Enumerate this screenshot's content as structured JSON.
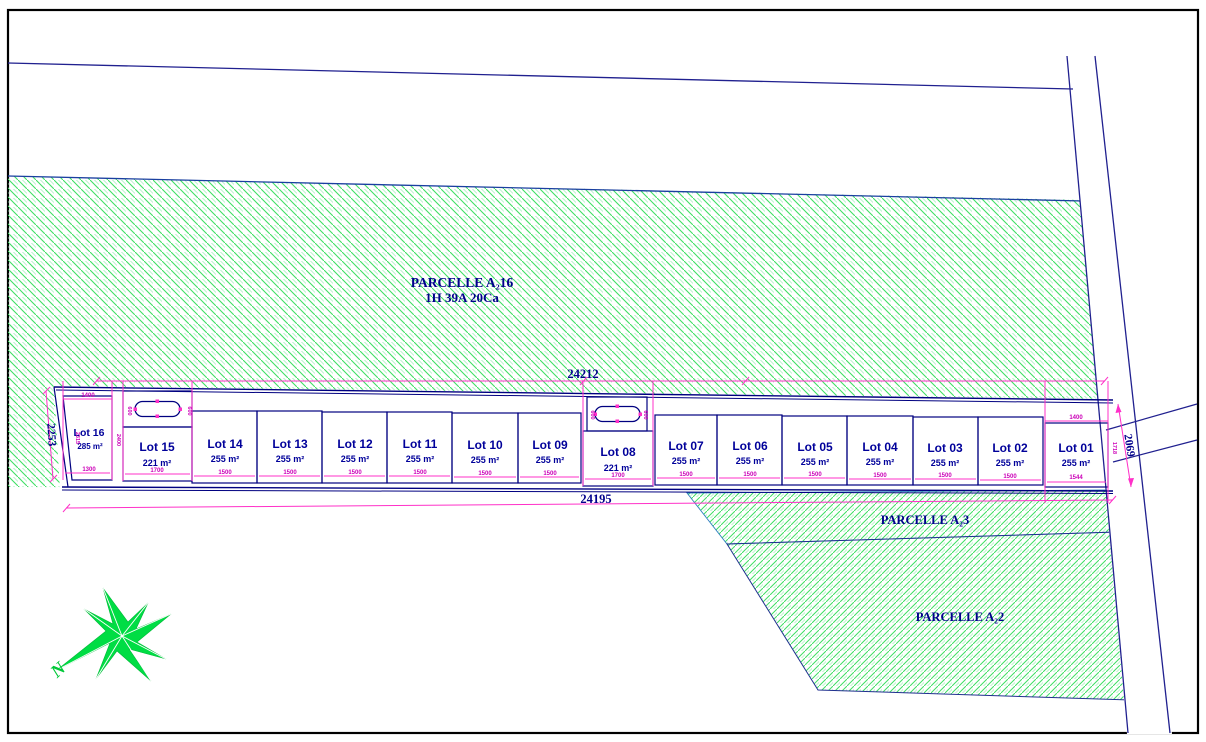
{
  "drawing_type": "cadastral subdivision plan",
  "parcelle_16": {
    "name": "PARCELLE A₂16",
    "area": "1H 39A 20Ca"
  },
  "parcelle_3": {
    "name": "PARCELLE A₂3"
  },
  "parcelle_2": {
    "name": "PARCELLE A₂2"
  },
  "dims": {
    "top": "24212",
    "bottom": "24195",
    "left": "2253",
    "right_road": "2069"
  },
  "compass": {
    "north_label": "N"
  },
  "colors": {
    "line_navy": "#000080",
    "text_navy": "#00008b",
    "dim_magenta": "#ff30c8",
    "dim_text_magenta": "#cc00b8",
    "hatch_green": "#3fdf63",
    "star_green": "#00dd44",
    "border_black": "#000000"
  },
  "ovals": [
    {
      "dim_left": "600",
      "dim_right": "600"
    },
    {
      "dim_left": "600",
      "dim_right": "600"
    }
  ],
  "lots": [
    {
      "name": "Lot 16",
      "area": "285 m²",
      "dim_bottom": "1300",
      "dim_top": "1400",
      "dim_left": "2315",
      "dim_right": "2400"
    },
    {
      "name": "Lot 15",
      "area": "221 m²",
      "dim_bottom": "1700"
    },
    {
      "name": "Lot 14",
      "area": "255 m²",
      "dim_bottom": "1500"
    },
    {
      "name": "Lot 13",
      "area": "255 m²",
      "dim_bottom": "1500"
    },
    {
      "name": "Lot 12",
      "area": "255 m²",
      "dim_bottom": "1500"
    },
    {
      "name": "Lot 11",
      "area": "255 m²",
      "dim_bottom": "1500"
    },
    {
      "name": "Lot 10",
      "area": "255 m²",
      "dim_bottom": "1500"
    },
    {
      "name": "Lot 09",
      "area": "255 m²",
      "dim_bottom": "1500"
    },
    {
      "name": "Lot 08",
      "area": "221 m²",
      "dim_bottom": "1700"
    },
    {
      "name": "Lot 07",
      "area": "255 m²",
      "dim_bottom": "1500"
    },
    {
      "name": "Lot 06",
      "area": "255 m²",
      "dim_bottom": "1500"
    },
    {
      "name": "Lot 05",
      "area": "255 m²",
      "dim_bottom": "1500"
    },
    {
      "name": "Lot 04",
      "area": "255 m²",
      "dim_bottom": "1500"
    },
    {
      "name": "Lot 03",
      "area": "255 m²",
      "dim_bottom": "1500"
    },
    {
      "name": "Lot 02",
      "area": "255 m²",
      "dim_bottom": "1500"
    },
    {
      "name": "Lot 01",
      "area": "255 m²",
      "dim_bottom": "1544",
      "dim_top": "1400",
      "dim_right": "1718"
    }
  ]
}
